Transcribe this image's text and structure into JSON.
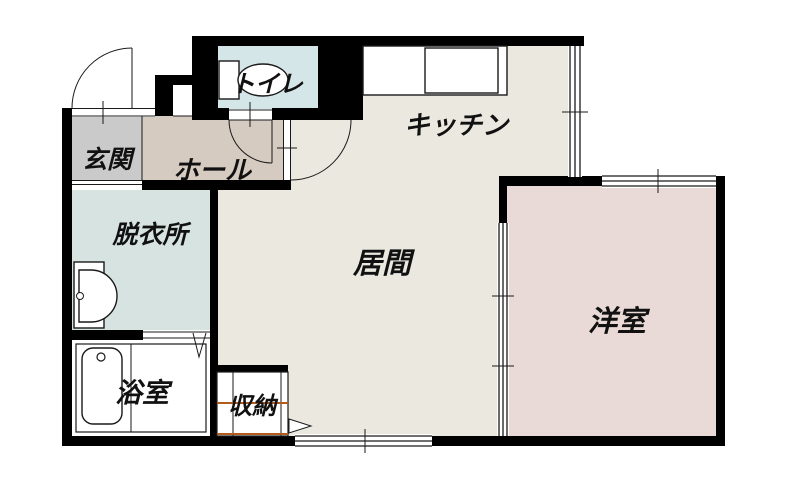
{
  "plan": {
    "name": "1DK間取り図",
    "rooms": {
      "genkan": {
        "label": "玄関",
        "color": "#cacaca"
      },
      "hall": {
        "label": "ホール",
        "color": "#d5cbc1"
      },
      "toilet": {
        "label": "トイレ",
        "color": "#d5e6e8"
      },
      "kitchen": {
        "label": "キッチン",
        "color": "#ebe8df"
      },
      "datsuijo": {
        "label": "脱衣所",
        "color": "#d7e3e0"
      },
      "ima": {
        "label": "居間",
        "color": "#ebe8df"
      },
      "yoshitsu": {
        "label": "洋室",
        "color": "#e9dad7"
      },
      "yokushitsu": {
        "label": "浴室",
        "color": "#ffffff"
      },
      "shuno": {
        "label": "収納",
        "color": "#ffffff"
      }
    },
    "accents": {
      "wall": "#000000",
      "closet_rail": "#b35a1f",
      "counter": "#e0e0e0",
      "line": "#1a1a1a"
    }
  }
}
